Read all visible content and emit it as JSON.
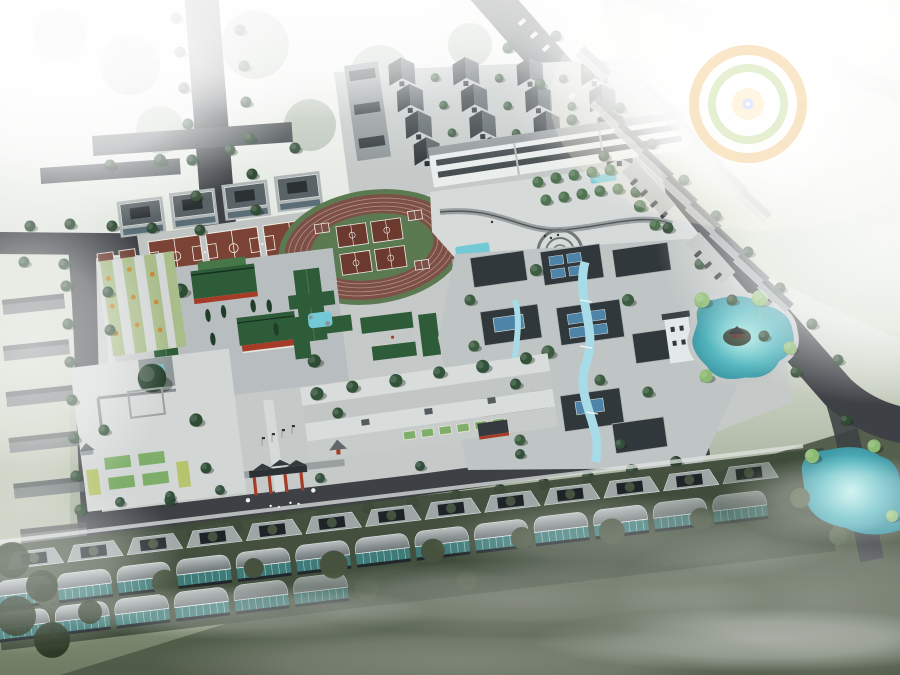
{
  "scene": {
    "kind": "architectural-aerial-rendering",
    "view": "birds-eye perspective of a traditional Chinese style school / cultural campus master plan, hazy white fog at edges, lens flare upper right",
    "elements": [
      "perimeter roads with street trees",
      "north cluster of dark gabled dormitory blocks",
      "long white teaching building with dark ribbon windows",
      "three outdoor basketball courts and garden plots",
      "oval running track with courts in the infield",
      "green-roofed traditional courtyard halls with red walls",
      "central paved plaza with curved paths and circular feature",
      "modern grey-roofed courtyard complex with blue skylights and water channels",
      "turquoise landscape pond with island pavilion and willows",
      "south entrance paifang gate with red columns",
      "terraced south garden with planting beds",
      "long row of greenhouse sheds with teal glass along the south road",
      "foggy village courtyard rows on the west and northeast",
      "dark misty farm fields at the bottom right",
      "lens flare"
    ]
  },
  "palette": {
    "bgTop": "#f7f8f6",
    "bgMid": "#e6eae4",
    "bgLow": "#c7cfc0",
    "bgBottom": "#6f7c63",
    "road": "#3d4145",
    "paving": "#c5cac9",
    "pavingLight": "#d2d6d5",
    "plaza": "#d6dad9",
    "whiteFacade": "#e9edec",
    "slateDark": "#31383b",
    "slateMid": "#5a6367",
    "gableFace": "#c6cccc",
    "windowDark": "#262c30",
    "greenRoof": "#2e5b38",
    "greenRoofLight": "#477748",
    "redWall": "#a63b28",
    "court": "#7a4336",
    "courtDark": "#6b392e",
    "trackLane": "#7c5047",
    "trackLine": "#c9a79c",
    "fieldGreen": "#5c7a52",
    "lawn": "#a9bc8a",
    "bedGreen": "#7fae6a",
    "bedYellow": "#b7c46e",
    "orangeFlower": "#c8862f",
    "glassBlue": "#4d84a8",
    "waterChannel": "#a8dbe8",
    "poolCyan": "#74c9d6",
    "pondTeal": "#55b7bf",
    "greenhouseTeal": "#3d7a78",
    "vegDark": "#3f4b3a",
    "fieldDark": "#4f5a48",
    "treeDark": "#2e4a33",
    "treeMid": "#3f6044",
    "treeLight": "#4f7350",
    "willow": "#8cba72",
    "flareGold": "#f3c478",
    "flareGreen": "#c4dc96",
    "flareCore": "#dfeaff"
  }
}
